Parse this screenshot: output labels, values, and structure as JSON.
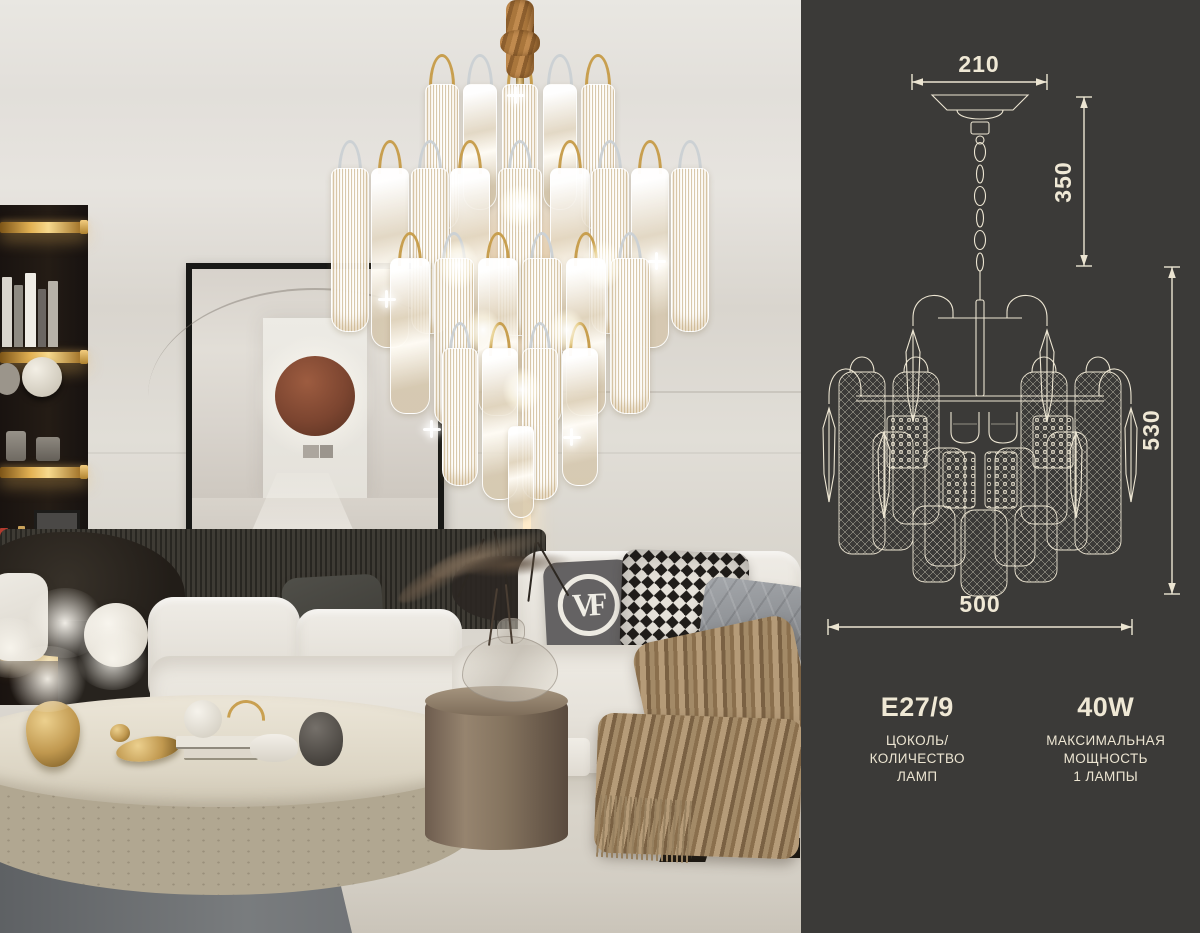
{
  "panel": {
    "background_color": "#3b3a38",
    "line_color": "#ece5d2",
    "dimensions": {
      "canopy_width_mm": "210",
      "suspension_height_mm": "350",
      "fixture_height_mm": "530",
      "fixture_width_mm": "500"
    },
    "specs": [
      {
        "value": "E27/9",
        "caption_lines": [
          "ЦОКОЛЬ/",
          "КОЛИЧЕСТВО",
          "ЛАМП"
        ]
      },
      {
        "value": "40W",
        "caption_lines": [
          "МАКСИМАЛЬНАЯ",
          "МОЩНОСТЬ",
          "1 ЛАМПЫ"
        ]
      }
    ]
  },
  "photo": {
    "pillow_monogram": "VF",
    "palette": {
      "wall": "#ddd9d2",
      "sofa": "#e9e6df",
      "gold_accent": "#c9a050",
      "cord": "#b07a42",
      "rug": "#6e7173",
      "carpet": "#d5d0c6",
      "art_circle": "#7c4530"
    }
  }
}
